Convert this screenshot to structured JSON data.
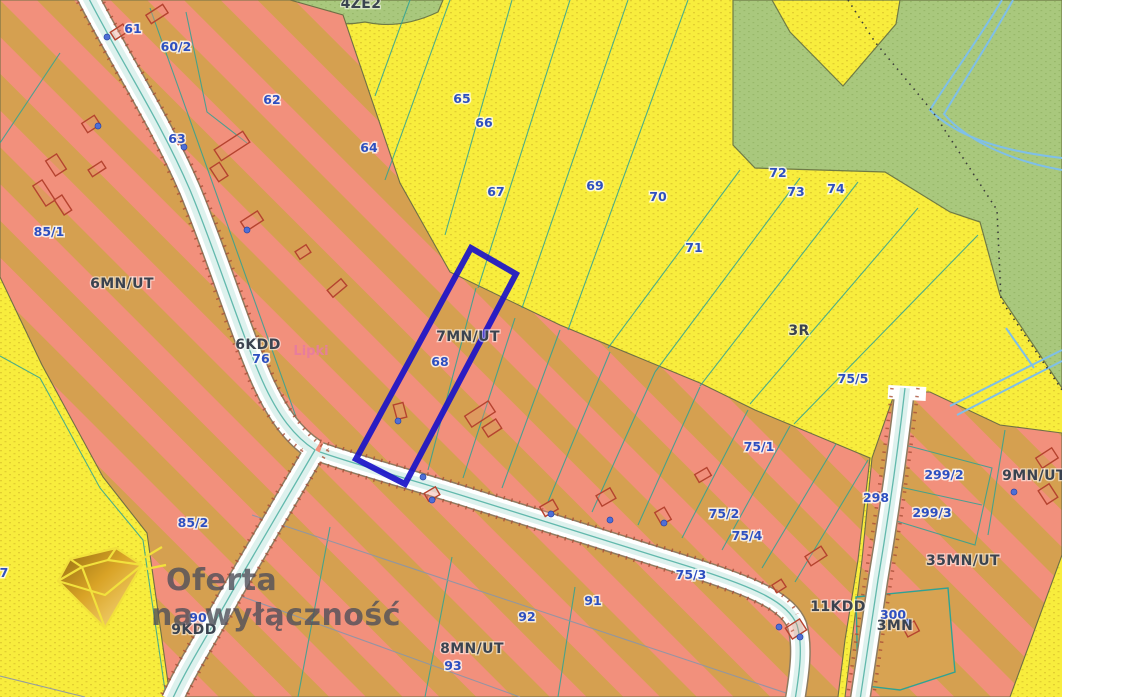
{
  "title": "Zoning map (MPZP) with highlighted parcel",
  "colors": {
    "parcel_label": "#2d4fc0",
    "zone_label": "#3a4350",
    "place_label": "#e87ca0",
    "highlight_outline": "#1a12c8",
    "farmland_yellow": "#f8ed3d",
    "zone_stripe_salmon": "#f2907c",
    "zone_stripe_tan": "#d5a050",
    "green_zone": "#a9c87d",
    "road_white": "#ffffff",
    "stream_blue": "#7fbfe8",
    "parcel_line_teal": "#2fa294",
    "building_outline": "#b5432f",
    "watermark_gold": "#d9a326",
    "watermark_text": "#50505a"
  },
  "watermark": {
    "line1": "Oferta",
    "line2": "na wyłączność"
  },
  "map": {
    "highlighted_parcel": "68",
    "parcel_labels": [
      {
        "text": "61",
        "x": 133,
        "y": 33
      },
      {
        "text": "60/2",
        "x": 176,
        "y": 51
      },
      {
        "text": "62",
        "x": 272,
        "y": 104
      },
      {
        "text": "63",
        "x": 177,
        "y": 143
      },
      {
        "text": "64",
        "x": 369,
        "y": 152
      },
      {
        "text": "65",
        "x": 462,
        "y": 103
      },
      {
        "text": "66",
        "x": 484,
        "y": 127
      },
      {
        "text": "67",
        "x": 496,
        "y": 196
      },
      {
        "text": "69",
        "x": 595,
        "y": 190
      },
      {
        "text": "70",
        "x": 658,
        "y": 201
      },
      {
        "text": "71",
        "x": 694,
        "y": 252
      },
      {
        "text": "72",
        "x": 778,
        "y": 177
      },
      {
        "text": "73",
        "x": 796,
        "y": 196
      },
      {
        "text": "74",
        "x": 836,
        "y": 193
      },
      {
        "text": "85/1",
        "x": 49,
        "y": 236
      },
      {
        "text": "85/2",
        "x": 193,
        "y": 527
      },
      {
        "text": "76",
        "x": 261,
        "y": 363
      },
      {
        "text": "68",
        "x": 440,
        "y": 366
      },
      {
        "text": "75/5",
        "x": 853,
        "y": 383
      },
      {
        "text": "75/1",
        "x": 759,
        "y": 451
      },
      {
        "text": "75/2",
        "x": 724,
        "y": 518
      },
      {
        "text": "75/4",
        "x": 747,
        "y": 540
      },
      {
        "text": "75/3",
        "x": 691,
        "y": 579
      },
      {
        "text": "298",
        "x": 876,
        "y": 502
      },
      {
        "text": "299/2",
        "x": 944,
        "y": 479
      },
      {
        "text": "299/3",
        "x": 932,
        "y": 517
      },
      {
        "text": "91",
        "x": 593,
        "y": 605
      },
      {
        "text": "92",
        "x": 527,
        "y": 621
      },
      {
        "text": "93",
        "x": 453,
        "y": 670
      },
      {
        "text": "300",
        "x": 893,
        "y": 619
      },
      {
        "text": "90",
        "x": 198,
        "y": 622
      },
      {
        "text": "7",
        "x": 4,
        "y": 577
      }
    ],
    "zone_labels": [
      {
        "text": "6MN/UT",
        "x": 122,
        "y": 288
      },
      {
        "text": "7MN/UT",
        "x": 468,
        "y": 341
      },
      {
        "text": "8MN/UT",
        "x": 472,
        "y": 653
      },
      {
        "text": "35MN/UT",
        "x": 963,
        "y": 565
      },
      {
        "text": "9MN/UT",
        "x": 1034,
        "y": 480
      },
      {
        "text": "3R",
        "x": 799,
        "y": 335
      },
      {
        "text": "4ZE2",
        "x": 361,
        "y": 8
      },
      {
        "text": "6KDD",
        "x": 258,
        "y": 349
      },
      {
        "text": "9KDD",
        "x": 194,
        "y": 634
      },
      {
        "text": "11KDD",
        "x": 838,
        "y": 611
      },
      {
        "text": "3MN",
        "x": 895,
        "y": 630
      }
    ],
    "place_labels": [
      {
        "text": "Lipki",
        "x": 311,
        "y": 355
      }
    ]
  }
}
